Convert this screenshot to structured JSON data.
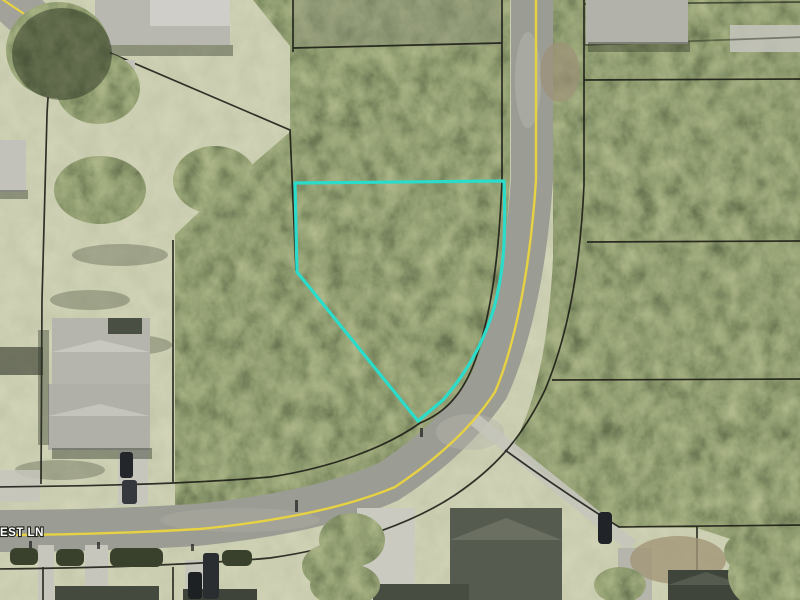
{
  "map": {
    "street_label": "EST LN",
    "colors": {
      "parcel_highlight": "#2BDCCB",
      "road_centerline": "#E6D243",
      "parcel_boundary": "#1B1B15",
      "street_label_text": "#FFFFFF"
    }
  }
}
